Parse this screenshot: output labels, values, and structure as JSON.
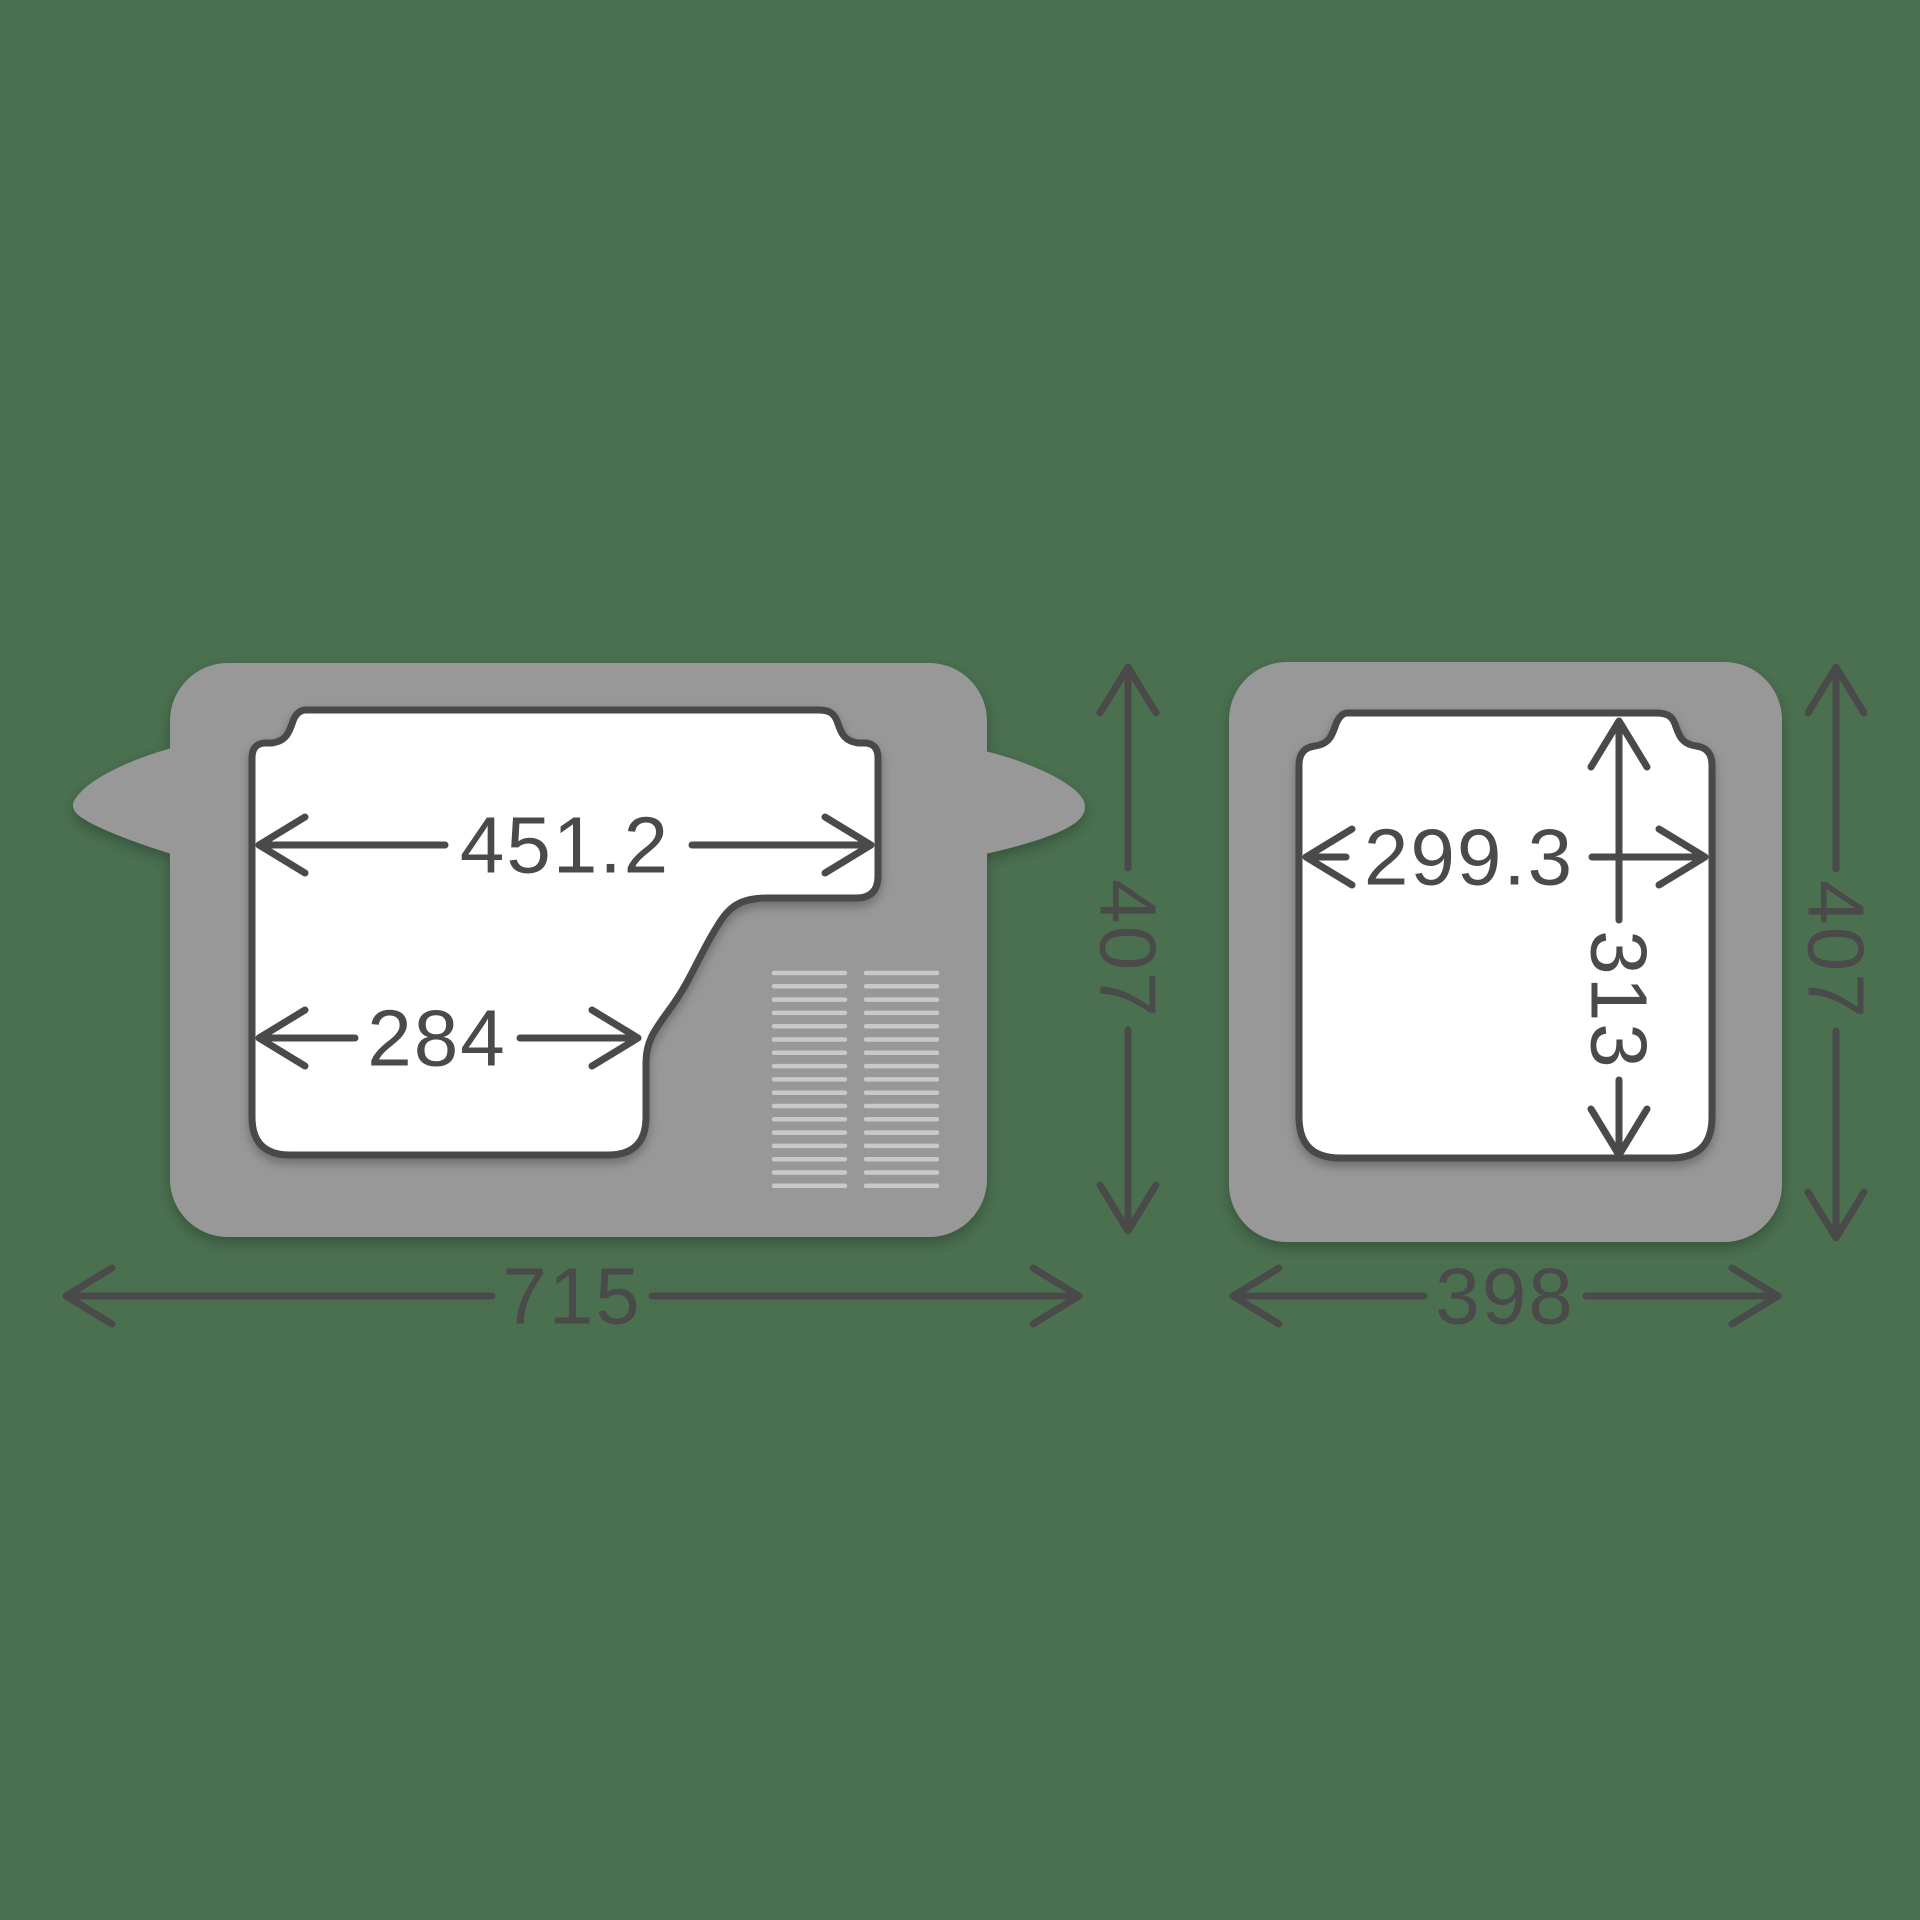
{
  "diagram": {
    "side_view": {
      "inner_top_width": "451.2",
      "inner_bottom_width": "284",
      "overall_width": "715",
      "overall_height": "407"
    },
    "front_view": {
      "inner_width": "299.3",
      "inner_height": "313",
      "overall_width": "398",
      "overall_height": "407"
    },
    "colors": {
      "background": "#4A7050",
      "body_grey": "#989898",
      "outline_dark": "#4A4A4A",
      "vent_grey": "#C9C9C9",
      "cavity_white": "#FFFFFF"
    }
  }
}
